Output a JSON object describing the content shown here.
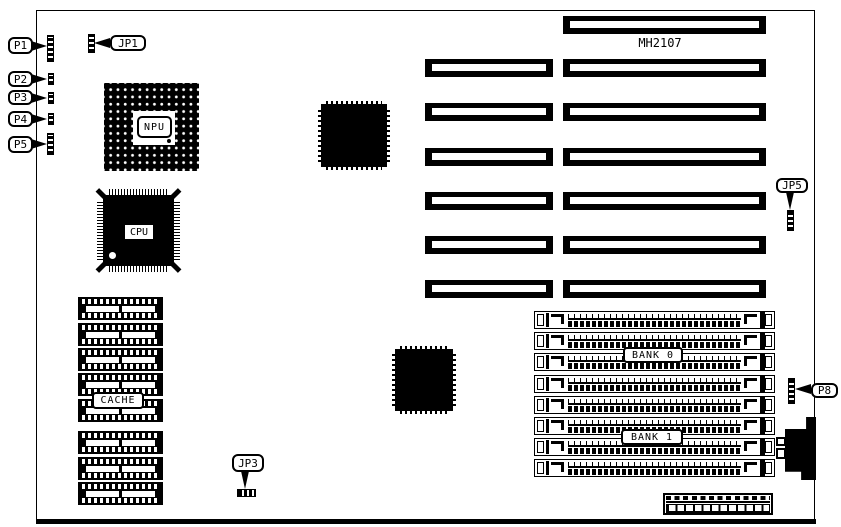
{
  "board": {
    "model": "MH2107",
    "chips": {
      "npu": "NPU",
      "cpu": "CPU",
      "cache": "CACHE"
    },
    "memory": {
      "bank0": "BANK 0",
      "bank1": "BANK 1"
    },
    "callouts": {
      "p1": "P1",
      "p2": "P2",
      "p3": "P3",
      "p4": "P4",
      "p5": "P5",
      "jp1": "JP1",
      "jp3": "JP3",
      "jp5": "JP5",
      "p8": "P8"
    },
    "colors": {
      "ink": "#000000",
      "paper": "#ffffff"
    }
  }
}
